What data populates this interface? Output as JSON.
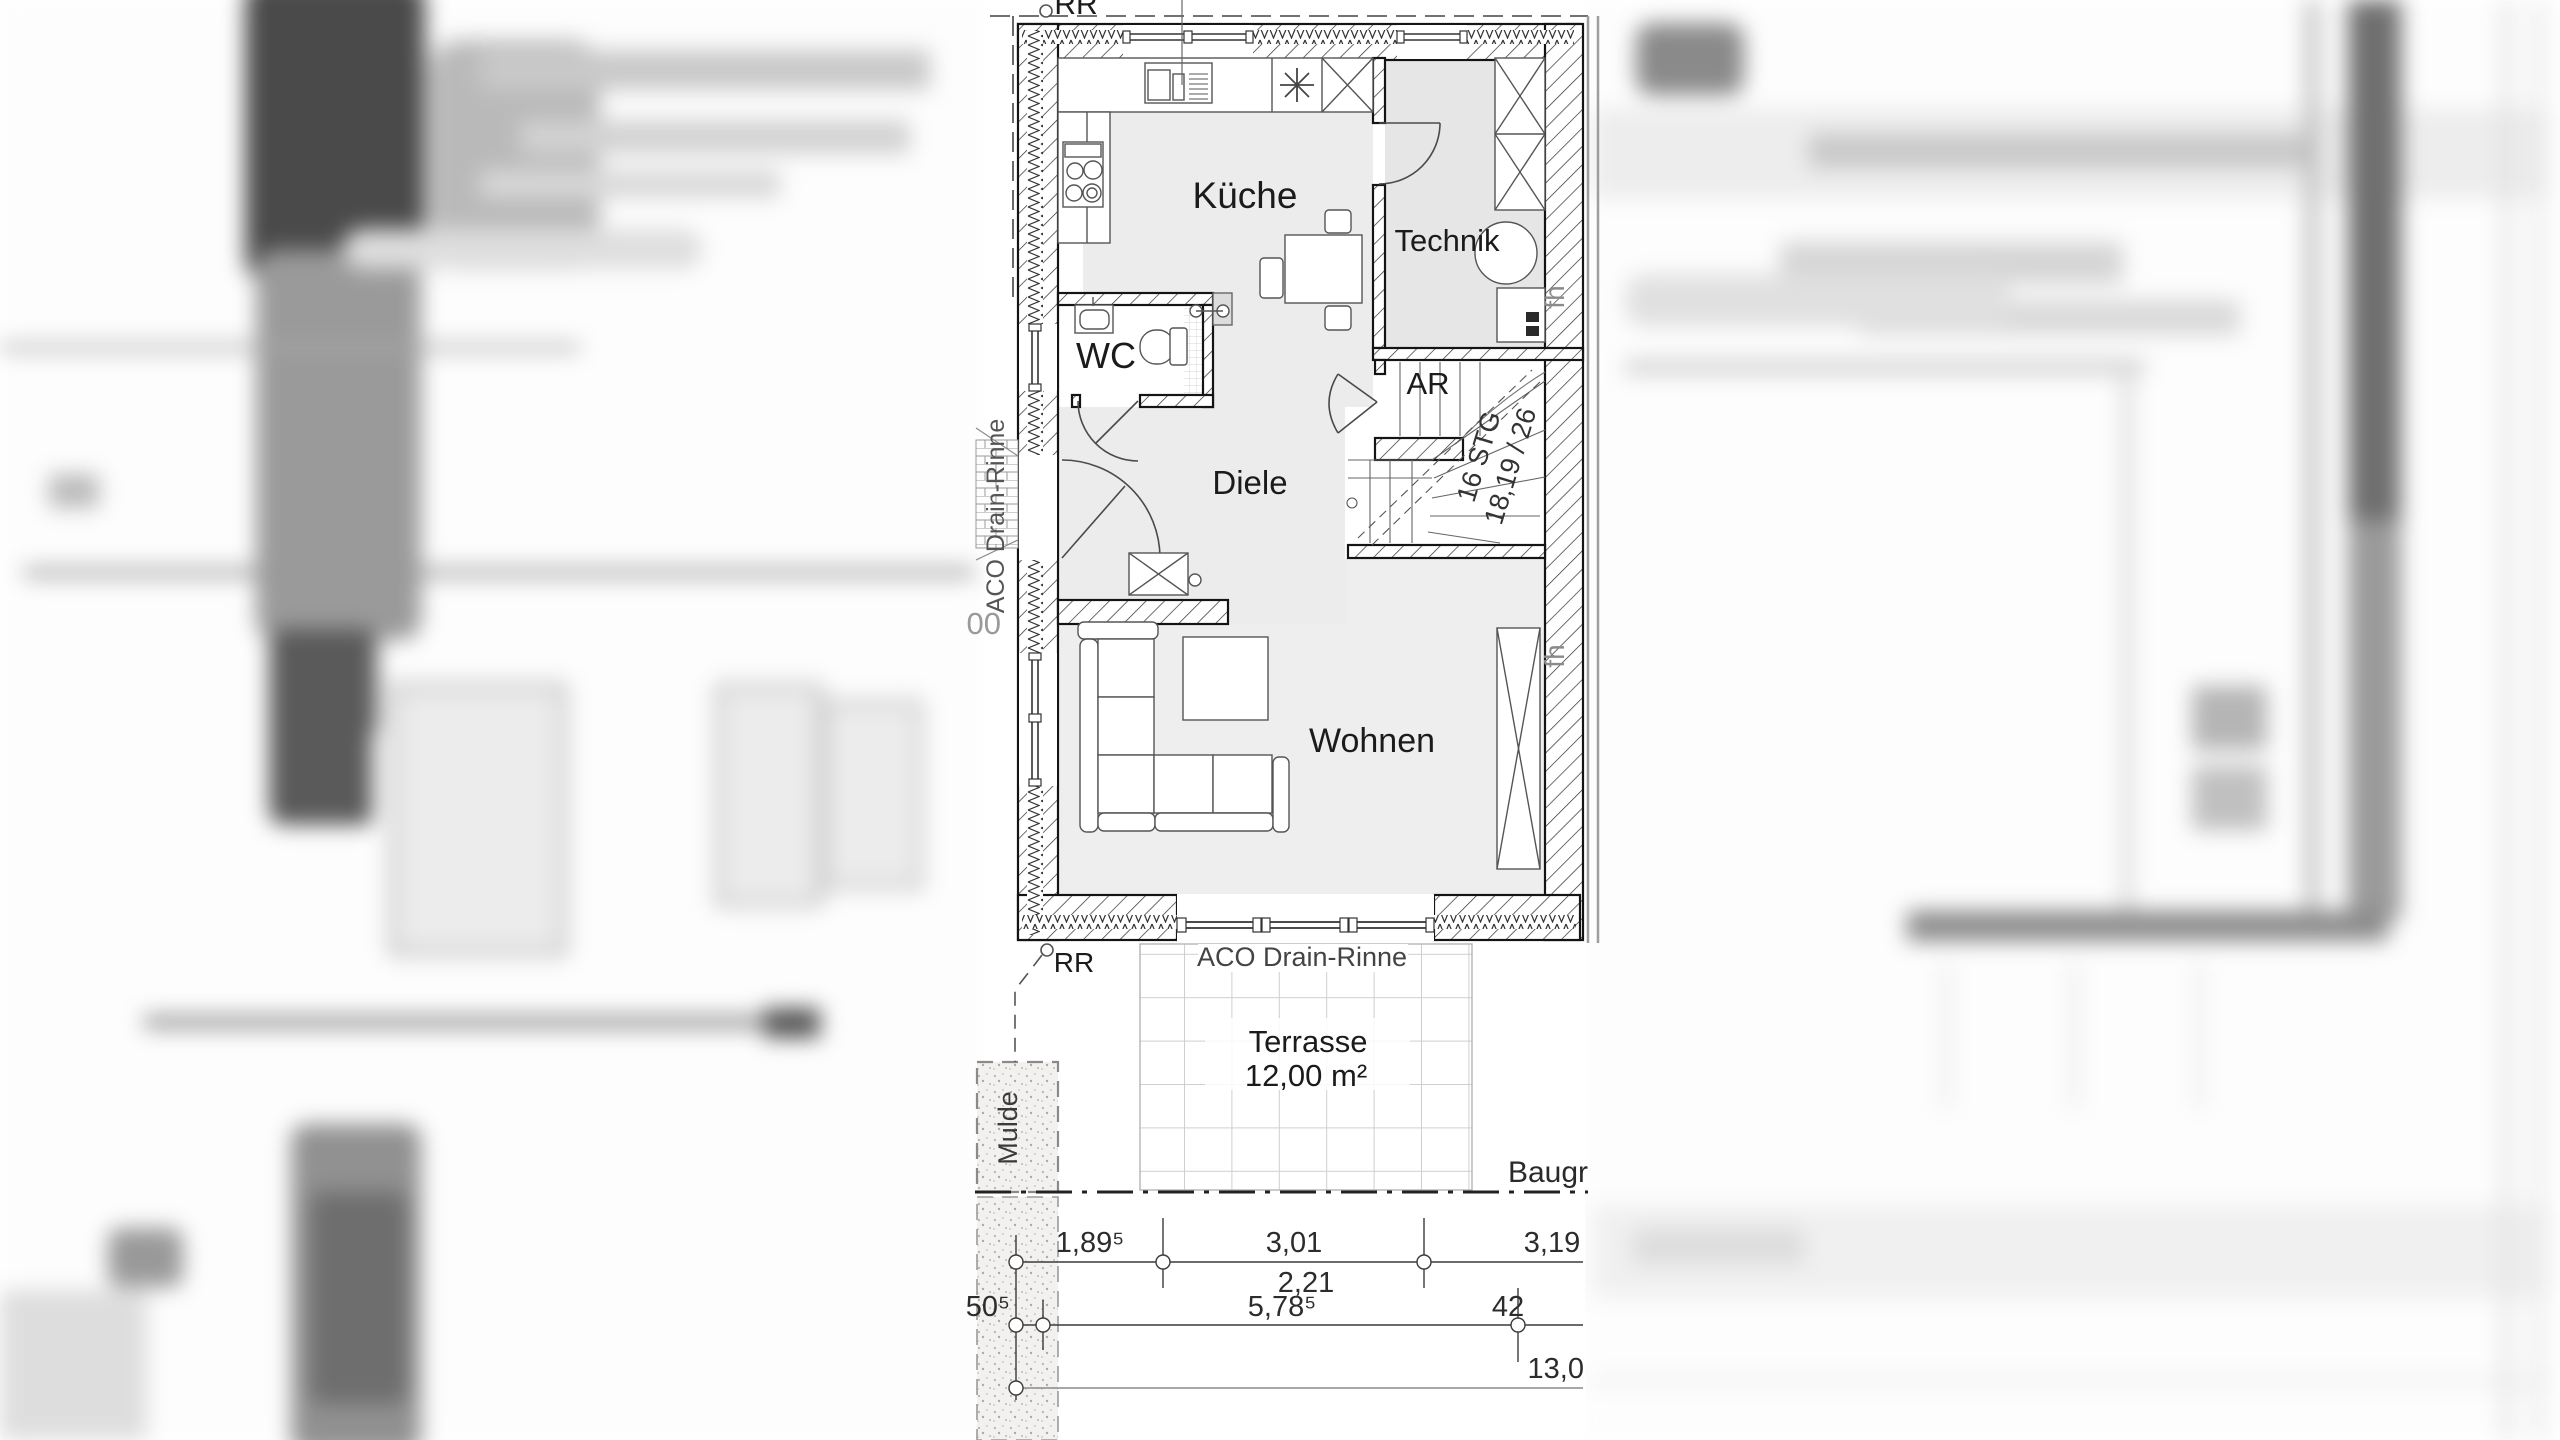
{
  "drawing": {
    "kind": "floor-plan",
    "language": "de",
    "rooms": {
      "kueche": "Küche",
      "technik": "Technik",
      "wc": "WC",
      "diele": "Diele",
      "ar": "AR",
      "wohnen": "Wohnen"
    },
    "stairs": {
      "line1": "16 STG",
      "line2": "18,19 / 26"
    },
    "annotations": {
      "rr_top": "RR",
      "rr_bottom": "RR",
      "aco_left": "ACO Drain-Rinne",
      "aco_bottom": "ACO Drain-Rinne",
      "terrasse": "Terrasse",
      "terrasse_area": "12,00 m²",
      "mulde": "Mulde",
      "baugrenze": "Baugr",
      "fh_upper": "fh",
      "fh_lower": "fh",
      "partial_dim_left": "00"
    },
    "dimensions": {
      "row1": [
        "1,89⁵",
        "3,01",
        "3,19"
      ],
      "row1_sub": "2,21",
      "row2": [
        "50⁵",
        "5,78⁵",
        "42"
      ],
      "row3": "13,0"
    },
    "colors": {
      "wall_line": "#141414",
      "floor_light": "#efefef",
      "floor_mid": "#e7e7e7",
      "annotation_gray": "#8a8a8a",
      "dim_text": "#2c2c2c"
    }
  }
}
